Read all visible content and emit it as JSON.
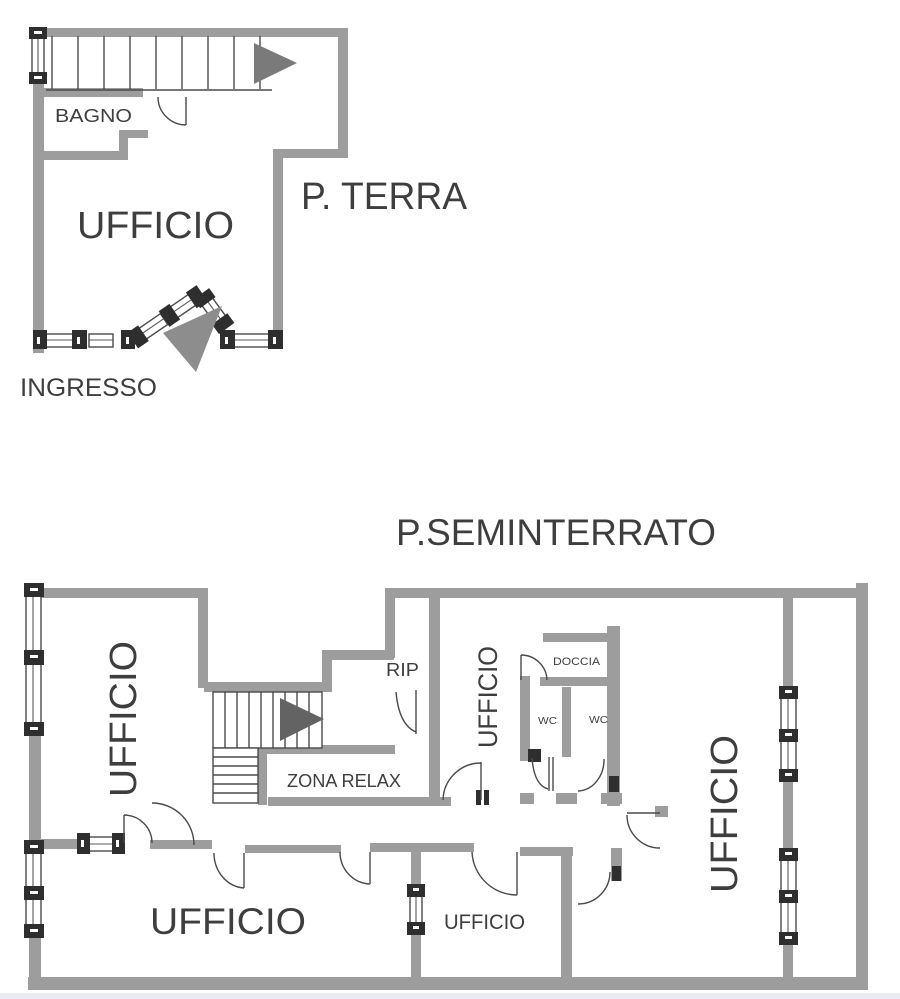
{
  "ground_floor": {
    "title": "P. TERRA",
    "rooms": {
      "bagno": "BAGNO",
      "ufficio": "UFFICIO"
    },
    "entrance_label": "INGRESSO"
  },
  "basement_floor": {
    "title": "P.SEMINTERRATO",
    "rooms": {
      "ufficio_left": "UFFICIO",
      "ufficio_middle": "UFFICIO",
      "ufficio_right": "UFFICIO",
      "ufficio_bottom_large": "UFFICIO",
      "ufficio_bottom_small": "UFFICIO",
      "rip": "RIP",
      "doccia": "DOCCIA",
      "wc_left": "WC",
      "wc_right": "WC",
      "zona_relax": "ZONA RELAX"
    }
  },
  "colors": {
    "wall": "#9d9d9d",
    "thin_line": "#4a4a4a",
    "window_cap": "#2e2e2e",
    "text": "#3e3e3e",
    "stair_arrow": "#6a6a6a",
    "entrance_arrow": "#8d8d8d",
    "background": "#ffffff"
  }
}
